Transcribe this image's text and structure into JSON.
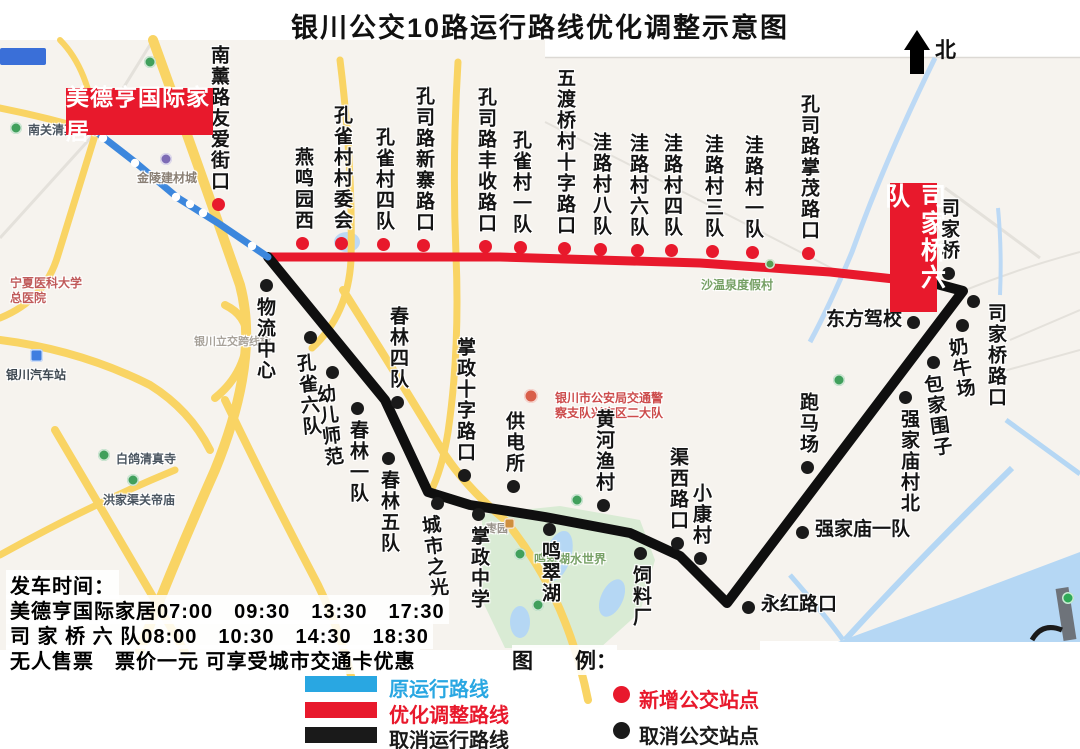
{
  "title": "银川公交10路运行路线优化调整示意图",
  "north_label": "北",
  "terminals": {
    "start": {
      "label": "美德亨国际家居"
    },
    "end": {
      "label": "司家桥六队"
    }
  },
  "routes": {
    "original": {
      "color": "#3c87dd",
      "points": [
        [
          95,
          131
        ],
        [
          135,
          162
        ],
        [
          178,
          198
        ],
        [
          218,
          223
        ],
        [
          268,
          257
        ]
      ],
      "stop_circles": [
        [
          103,
          138
        ],
        [
          135,
          163
        ],
        [
          176,
          197
        ],
        [
          190,
          204
        ],
        [
          203,
          213
        ],
        [
          252,
          246
        ]
      ]
    },
    "optimized": {
      "color": "#e8192c",
      "points": [
        [
          268,
          257
        ],
        [
          500,
          257
        ],
        [
          700,
          263
        ],
        [
          830,
          272
        ],
        [
          940,
          284
        ]
      ]
    },
    "cancelled": {
      "color": "#0f0f0f",
      "points": [
        [
          937,
          284
        ],
        [
          963,
          291
        ],
        [
          727,
          603
        ],
        [
          680,
          556
        ],
        [
          630,
          533
        ],
        [
          545,
          517
        ],
        [
          470,
          505
        ],
        [
          428,
          492
        ],
        [
          385,
          400
        ],
        [
          268,
          257
        ]
      ]
    }
  },
  "stops": [
    {
      "name": "南薰路友爱街口",
      "type": "new",
      "orient": "v",
      "side": "above",
      "dot": [
        218,
        204
      ]
    },
    {
      "name": "燕鸣园西",
      "type": "new",
      "orient": "v",
      "side": "above",
      "dot": [
        302,
        243
      ]
    },
    {
      "name": "孔雀村村委会",
      "type": "new",
      "orient": "v",
      "side": "above",
      "dot": [
        341,
        243
      ]
    },
    {
      "name": "孔雀村四队",
      "type": "new",
      "orient": "v",
      "side": "above",
      "dot": [
        383,
        244
      ]
    },
    {
      "name": "孔司路新寨路口",
      "type": "new",
      "orient": "v",
      "side": "above",
      "dot": [
        423,
        245
      ]
    },
    {
      "name": "孔司路丰收路口",
      "type": "new",
      "orient": "v",
      "side": "above",
      "dot": [
        485,
        246
      ]
    },
    {
      "name": "孔雀村一队",
      "type": "new",
      "orient": "v",
      "side": "above",
      "dot": [
        520,
        247
      ]
    },
    {
      "name": "五渡桥村十字路口",
      "type": "new",
      "orient": "v",
      "side": "above",
      "dot": [
        564,
        248
      ]
    },
    {
      "name": "洼路村八队",
      "type": "new",
      "orient": "v",
      "side": "above",
      "dot": [
        600,
        249
      ]
    },
    {
      "name": "洼路村六队",
      "type": "new",
      "orient": "v",
      "side": "above",
      "dot": [
        637,
        250
      ]
    },
    {
      "name": "洼路村四队",
      "type": "new",
      "orient": "v",
      "side": "above",
      "dot": [
        671,
        250
      ]
    },
    {
      "name": "洼路村三队",
      "type": "new",
      "orient": "v",
      "side": "above",
      "dot": [
        712,
        251
      ]
    },
    {
      "name": "洼路村一队",
      "type": "new",
      "orient": "v",
      "side": "above",
      "dot": [
        752,
        252
      ]
    },
    {
      "name": "孔司路掌茂路口",
      "type": "new",
      "orient": "v",
      "side": "above",
      "dot": [
        808,
        253
      ]
    },
    {
      "name": "物流中心",
      "type": "cancelled",
      "orient": "v",
      "side": "below",
      "dot": [
        266,
        285
      ],
      "dx": -2
    },
    {
      "name": "孔雀六队",
      "type": "cancelled",
      "orient": "v",
      "side": "below",
      "dot": [
        310,
        337
      ],
      "dx": -3,
      "dy": 4,
      "tilt": -5
    },
    {
      "name": "幼儿师范",
      "type": "cancelled",
      "orient": "v",
      "side": "below",
      "dot": [
        332,
        372
      ],
      "dx": -4,
      "tilt": -7
    },
    {
      "name": "春林四队",
      "type": "cancelled",
      "orient": "v",
      "side": "above",
      "dot": [
        397,
        402
      ]
    },
    {
      "name": "春林一队",
      "type": "cancelled",
      "orient": "v",
      "side": "below",
      "dot": [
        357,
        408
      ]
    },
    {
      "name": "春林五队",
      "type": "cancelled",
      "orient": "v",
      "side": "below",
      "dot": [
        388,
        458
      ]
    },
    {
      "name": "掌政十字路口",
      "type": "cancelled",
      "orient": "v",
      "side": "above",
      "dot": [
        464,
        475
      ]
    },
    {
      "name": "供电所",
      "type": "cancelled",
      "orient": "v",
      "side": "above",
      "dot": [
        513,
        486
      ]
    },
    {
      "name": "城市之光",
      "type": "cancelled",
      "orient": "v",
      "side": "below",
      "dot": [
        437,
        503
      ],
      "dx": -4,
      "tilt": -7
    },
    {
      "name": "掌政中学",
      "type": "cancelled",
      "orient": "v",
      "side": "below",
      "dot": [
        478,
        514
      ]
    },
    {
      "name": "鸣翠湖",
      "type": "cancelled",
      "orient": "v",
      "side": "below",
      "dot": [
        549,
        529
      ]
    },
    {
      "name": "黄河渔村",
      "type": "cancelled",
      "orient": "v",
      "side": "above",
      "dot": [
        603,
        505
      ]
    },
    {
      "name": "渠西路口",
      "type": "cancelled",
      "orient": "v",
      "side": "above",
      "dot": [
        677,
        543
      ]
    },
    {
      "name": "小康村",
      "type": "cancelled",
      "orient": "v",
      "side": "above",
      "dot": [
        700,
        558
      ]
    },
    {
      "name": "饲料厂",
      "type": "cancelled",
      "orient": "v",
      "side": "below",
      "dot": [
        640,
        553
      ]
    },
    {
      "name": "永红路口",
      "type": "cancelled",
      "orient": "h",
      "side": "right",
      "dot": [
        748,
        607
      ]
    },
    {
      "name": "跑马场",
      "type": "cancelled",
      "orient": "v",
      "side": "above",
      "dot": [
        807,
        467
      ]
    },
    {
      "name": "强家庙一队",
      "type": "cancelled",
      "orient": "h",
      "side": "right",
      "dot": [
        802,
        532
      ]
    },
    {
      "name": "强家庙村北",
      "type": "cancelled",
      "orient": "v",
      "side": "below",
      "dot": [
        905,
        397
      ],
      "dx": 3
    },
    {
      "name": "包家围子",
      "type": "cancelled",
      "orient": "v",
      "side": "below",
      "dot": [
        933,
        362
      ],
      "dx": 3,
      "tilt": -8
    },
    {
      "name": "奶牛场",
      "type": "cancelled",
      "orient": "v",
      "side": "below",
      "dot": [
        962,
        325
      ],
      "dx": -2,
      "tilt": -10
    },
    {
      "name": "东方驾校",
      "type": "cancelled",
      "orient": "h",
      "side": "left",
      "dot": [
        913,
        322
      ]
    },
    {
      "name": "司家桥",
      "type": "cancelled",
      "orient": "v",
      "side": "above",
      "dot": [
        948,
        273
      ]
    },
    {
      "name": "司家桥路口",
      "type": "cancelled",
      "orient": "v",
      "side": "below",
      "dot": [
        973,
        301
      ],
      "dx": 22,
      "dy": -10
    }
  ],
  "map_labels": [
    {
      "text": "南关清真大寺",
      "x": 28,
      "y": 121,
      "color": "#4a5560",
      "size": 12
    },
    {
      "text": "金陵建材城",
      "x": 137,
      "y": 169,
      "color": "#8a7f74",
      "size": 12
    },
    {
      "text": "宁夏医科大学",
      "x": 10,
      "y": 274,
      "color": "#c05a5a",
      "size": 12
    },
    {
      "text": "总医院",
      "x": 10,
      "y": 289,
      "color": "#c05a5a",
      "size": 12
    },
    {
      "text": "银川汽车站",
      "x": 6,
      "y": 366,
      "color": "#3d4750",
      "size": 12
    },
    {
      "text": "白鸽清真寺",
      "x": 116,
      "y": 450,
      "color": "#4a5560",
      "size": 12
    },
    {
      "text": "洪家渠关帝庙",
      "x": 103,
      "y": 491,
      "color": "#4a5560",
      "size": 12
    },
    {
      "text": "银川立交跨线桥",
      "x": 194,
      "y": 333,
      "color": "#a8a29a",
      "size": 11
    },
    {
      "text": "沙温泉度假村",
      "x": 701,
      "y": 276,
      "color": "#76a065",
      "size": 12
    },
    {
      "text": "银川市公安局交通警",
      "x": 555,
      "y": 389,
      "color": "#cc4b4b",
      "size": 12
    },
    {
      "text": "察支队兴庆区二大队",
      "x": 555,
      "y": 404,
      "color": "#cc4b4b",
      "size": 12
    },
    {
      "text": "鸣翠湖水世界",
      "x": 534,
      "y": 550,
      "color": "#76a065",
      "size": 12
    },
    {
      "text": "枣园",
      "x": 486,
      "y": 520,
      "color": "#98928a",
      "size": 11
    }
  ],
  "map_icons": [
    {
      "name": "mosque-icon",
      "shape": "circle",
      "x": 16,
      "y": 128,
      "d": 12,
      "color": "#41a05c"
    },
    {
      "name": "park-icon",
      "shape": "circle",
      "x": 150,
      "y": 62,
      "d": 12,
      "color": "#41a05c"
    },
    {
      "name": "building-icon",
      "shape": "circle",
      "x": 166,
      "y": 159,
      "d": 12,
      "color": "#7d6bb5"
    },
    {
      "name": "bus-station-icon",
      "shape": "square",
      "x": 36,
      "y": 355,
      "d": 13,
      "color": "#3f7de0"
    },
    {
      "name": "mosque-icon",
      "shape": "circle",
      "x": 104,
      "y": 455,
      "d": 12,
      "color": "#41a05c"
    },
    {
      "name": "temple-icon",
      "shape": "circle",
      "x": 133,
      "y": 480,
      "d": 12,
      "color": "#41a05c"
    },
    {
      "name": "resort-icon",
      "shape": "circle",
      "x": 770,
      "y": 264,
      "d": 10,
      "color": "#5a9e53"
    },
    {
      "name": "police-icon",
      "shape": "circle",
      "x": 531,
      "y": 396,
      "d": 14,
      "color": "#d95f4a"
    },
    {
      "name": "park-icon",
      "shape": "circle",
      "x": 520,
      "y": 554,
      "d": 12,
      "color": "#41a05c"
    },
    {
      "name": "orchard-icon",
      "shape": "square",
      "x": 509,
      "y": 523,
      "d": 11,
      "color": "#cf8f3e"
    },
    {
      "name": "park-icon",
      "shape": "circle",
      "x": 839,
      "y": 380,
      "d": 12,
      "color": "#41a05c"
    },
    {
      "name": "park-icon",
      "shape": "circle",
      "x": 577,
      "y": 500,
      "d": 12,
      "color": "#41a05c"
    },
    {
      "name": "park-icon",
      "shape": "circle",
      "x": 538,
      "y": 605,
      "d": 12,
      "color": "#41a05c"
    },
    {
      "name": "park-icon",
      "shape": "circle",
      "x": 1068,
      "y": 598,
      "d": 12,
      "color": "#2faa57"
    }
  ],
  "departure": {
    "heading": "发车时间：",
    "line1": "美德亨国际家居07:00　09:30　13:30　17:30",
    "line2": "司 家 桥 六 队08:00　10:30　14:30　18:30",
    "notice": "无人售票　票价一元 可享受城市交通卡优惠"
  },
  "legend": {
    "title": "图　　例：",
    "route_items": [
      {
        "label": "原运行路线",
        "color": "#29a7e2"
      },
      {
        "label": "优化调整路线",
        "color": "#e8192c"
      },
      {
        "label": "取消运行路线",
        "color": "#1a1a1a"
      }
    ],
    "stop_items": [
      {
        "label": "新增公交站点",
        "color": "#e8192c"
      },
      {
        "label": "取消公交站点",
        "color": "#1a1a1a"
      }
    ]
  }
}
